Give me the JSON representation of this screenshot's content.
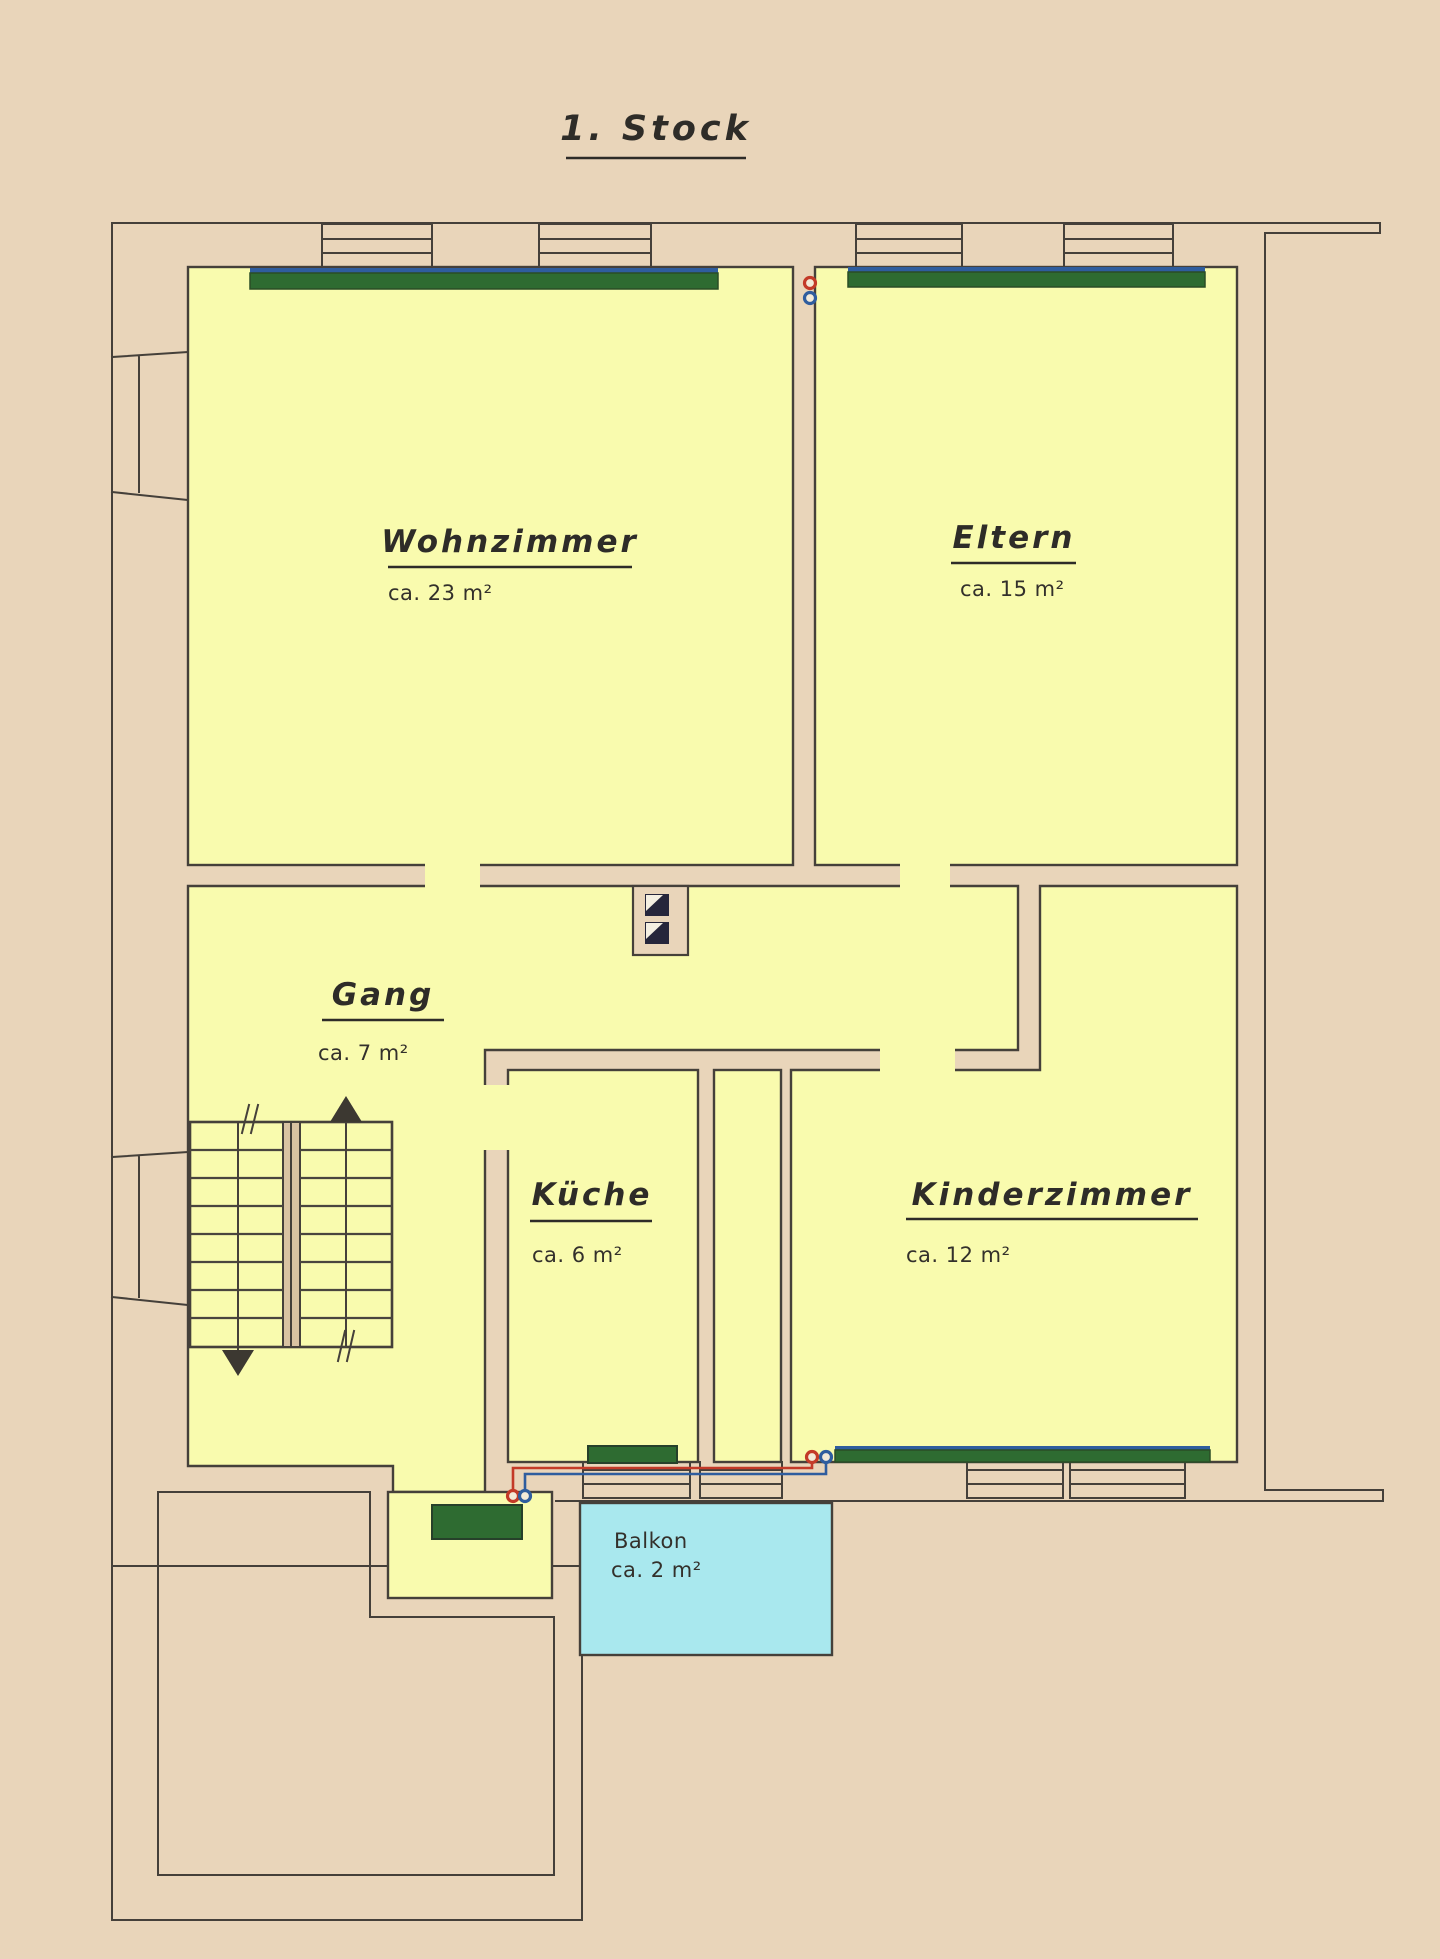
{
  "title": "1. Stock",
  "rooms": {
    "wohnzimmer": {
      "name": "Wohnzimmer",
      "area": "ca. 23 m²"
    },
    "eltern": {
      "name": "Eltern",
      "area": "ca. 15 m²"
    },
    "gang": {
      "name": "Gang",
      "area": "ca. 7 m²"
    },
    "kueche": {
      "name": "Küche",
      "area": "ca. 6 m²"
    },
    "kinderzimmer": {
      "name": "Kinderzimmer",
      "area": "ca. 12 m²"
    },
    "balkon": {
      "name": "Balkon",
      "area": "ca. 2 m²"
    }
  },
  "colors": {
    "paper": "#e9d5ba",
    "room_fill": "#f9fbae",
    "balcony_fill": "#a9e8ee",
    "radiator_green": "#2e6b31",
    "radiator_blue": "#2f5d9e",
    "pipe_red": "#c33a28",
    "pipe_blue": "#2f5d9e",
    "wall_line": "#45403a",
    "chimney_dark": "#26263b"
  },
  "legend": {
    "stair_up_arrow": "up",
    "stair_down_arrow": "down"
  }
}
